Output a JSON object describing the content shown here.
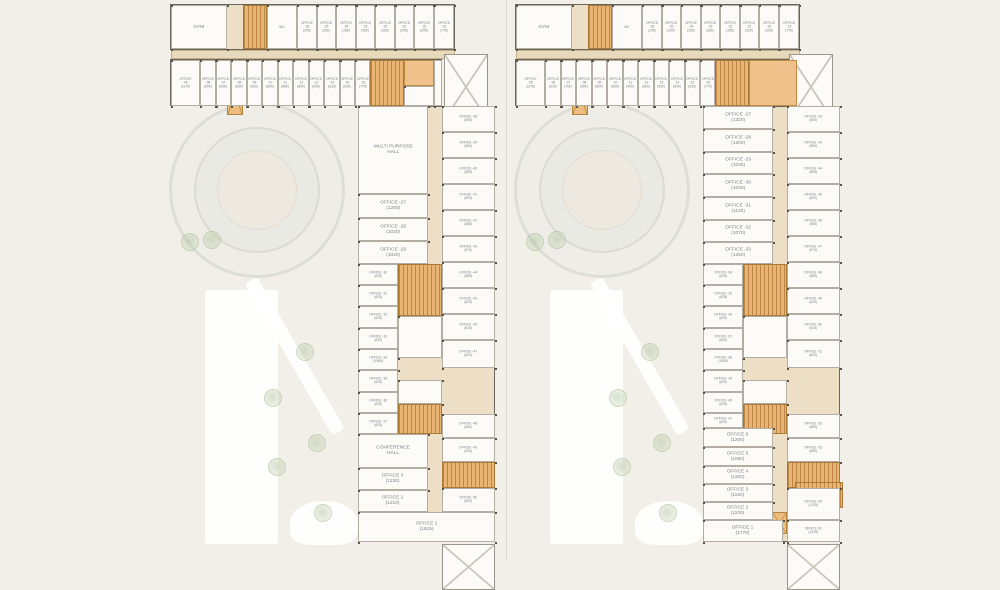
{
  "page": {
    "background": "#f2efe8",
    "divider_x": 506
  },
  "palette": {
    "corridor": "#ecdfc5",
    "room_white": "#fcfbf8",
    "core_orange": "#eec28a",
    "stair_orange": "#e8b574",
    "outline": "#6a665e",
    "label_text": "#7e7e85",
    "tree_green": "#a7bd92"
  },
  "plans": [
    {
      "name": "floor-plan-left",
      "x": 170,
      "y": 4,
      "w": 330,
      "h": 540,
      "site": {
        "circle": {
          "cx": 87,
          "cy": 186,
          "r": 88
        },
        "path_rect": {
          "x": 35,
          "y": 286,
          "w": 73,
          "h": 254
        },
        "path_diag": {
          "x": 75,
          "y": 280,
          "w": 14,
          "h": 175,
          "rot": -30
        },
        "path_blob": {
          "x": 120,
          "y": 497,
          "w": 68,
          "h": 44
        },
        "trees": [
          [
            20,
            238
          ],
          [
            42,
            236
          ],
          [
            135,
            348
          ],
          [
            103,
            394
          ],
          [
            147,
            439
          ],
          [
            107,
            463
          ],
          [
            153,
            509
          ]
        ]
      },
      "zones": [
        [
          0,
          0,
          285,
          46,
          "zone"
        ],
        [
          1,
          46,
          284,
          9,
          "tan"
        ],
        [
          0,
          55,
          272,
          47,
          "zone"
        ],
        [
          274,
          50,
          44,
          66,
          "ramp"
        ],
        [
          188,
          102,
          137,
          436,
          "zone"
        ]
      ],
      "rooms": [
        [
          1,
          1,
          56,
          44,
          "w",
          "GYM"
        ],
        [
          57,
          1,
          16,
          44,
          "lift"
        ],
        [
          73,
          1,
          24,
          44,
          "s"
        ],
        [
          97,
          1,
          30,
          44,
          "w",
          "WC"
        ],
        [
          127,
          1,
          19.5,
          44,
          "w",
          "OFFICE -26\n(295)"
        ],
        [
          146.5,
          1,
          19.5,
          44,
          "w",
          "OFFICE -25\n(290)"
        ],
        [
          166,
          1,
          19.5,
          44,
          "w",
          "OFFICE -24\n(285)"
        ],
        [
          185.5,
          1,
          19.5,
          44,
          "w",
          "OFFICE -23\n(280)"
        ],
        [
          205,
          1,
          19.5,
          44,
          "w",
          "OFFICE -22\n(285)"
        ],
        [
          224.5,
          1,
          19.5,
          44,
          "w",
          "OFFICE -21\n(290)"
        ],
        [
          244,
          1,
          19.5,
          44,
          "w",
          "OFFICE -20\n(295)"
        ],
        [
          263.5,
          1,
          20.5,
          44,
          "w",
          "OFFICE -19\n(775)"
        ],
        [
          1,
          56,
          29,
          46,
          "w",
          "OFFICE -05\n(1170)"
        ],
        [
          30,
          56,
          15.5,
          46,
          "w",
          "OFFICE -06\n(690)"
        ],
        [
          45.5,
          56,
          15.5,
          46,
          "w",
          "OFFICE -07\n(630)"
        ],
        [
          61,
          56,
          15.5,
          46,
          "w",
          "OFFICE -08\n(630)"
        ],
        [
          76.5,
          56,
          15.5,
          46,
          "w",
          "OFFICE -09\n(690)"
        ],
        [
          92,
          56,
          15.5,
          46,
          "w",
          "OFFICE -10\n(890)"
        ],
        [
          107.5,
          56,
          15.5,
          46,
          "w",
          "OFFICE -11\n(880)"
        ],
        [
          123,
          56,
          15.5,
          46,
          "w",
          "OFFICE -12\n(890)"
        ],
        [
          138.5,
          56,
          15.5,
          46,
          "w",
          "OFFICE -13\n(690)"
        ],
        [
          154,
          56,
          15.5,
          46,
          "w",
          "OFFICE -14\n(630)"
        ],
        [
          169.5,
          56,
          15.5,
          46,
          "w",
          "OFFICE -15\n(630)"
        ],
        [
          185,
          56,
          15,
          46,
          "w",
          "OFFICE -16\n(775)"
        ],
        [
          200,
          56,
          34,
          46,
          "s"
        ],
        [
          234,
          56,
          30,
          26,
          "o"
        ],
        [
          234,
          82,
          30,
          20,
          "w"
        ],
        [
          264,
          56,
          8,
          46,
          "w"
        ],
        [
          188,
          102,
          70,
          88,
          "w",
          "MULTI PURPOSE\nHALL"
        ],
        [
          188,
          190,
          70,
          24,
          "w",
          "OFFICE -27\n(1200)"
        ],
        [
          188,
          214,
          70,
          23,
          "w",
          "OFFICE -28\n(1030)"
        ],
        [
          188,
          237,
          70,
          23,
          "w",
          "OFFICE -29\n(1020)"
        ],
        [
          188,
          260,
          40,
          21,
          "w",
          "OFFICE -30\n(625)"
        ],
        [
          188,
          281,
          40,
          21,
          "w",
          "OFFICE -31\n(625)"
        ],
        [
          188,
          302,
          40,
          22,
          "w",
          "OFFICE -32\n(625)"
        ],
        [
          188,
          324,
          40,
          21,
          "w",
          "OFFICE -33\n(630)"
        ],
        [
          188,
          345,
          40,
          21,
          "w",
          "OFFICE -34\n(1060)"
        ],
        [
          188,
          366,
          40,
          22,
          "w",
          "OFFICE -35\n(625)"
        ],
        [
          188,
          388,
          40,
          21,
          "w",
          "OFFICE -36\n(625)"
        ],
        [
          188,
          409,
          40,
          21,
          "w",
          "OFFICE -37\n(625)"
        ],
        [
          228,
          260,
          44,
          52,
          "s"
        ],
        [
          228,
          312,
          44,
          42,
          "w"
        ],
        [
          228,
          354,
          14,
          22,
          "lift"
        ],
        [
          242,
          354,
          15,
          22,
          "lift"
        ],
        [
          257,
          354,
          15,
          22,
          "lift"
        ],
        [
          228,
          376,
          44,
          24,
          "w"
        ],
        [
          228,
          400,
          44,
          30,
          "s"
        ],
        [
          272,
          102,
          53,
          26,
          "w",
          "OFFICE -38\n(605)"
        ],
        [
          272,
          128,
          53,
          26,
          "w",
          "OFFICE -39\n(580)"
        ],
        [
          272,
          154,
          53,
          26,
          "w",
          "OFFICE -40\n(595)"
        ],
        [
          272,
          180,
          53,
          26,
          "w",
          "OFFICE -41\n(600)"
        ],
        [
          272,
          206,
          53,
          26,
          "w",
          "OFFICE -42\n(585)"
        ],
        [
          272,
          232,
          53,
          26,
          "w",
          "OFFICE -43\n(570)"
        ],
        [
          272,
          258,
          53,
          26,
          "w",
          "OFFICE -44\n(565)"
        ],
        [
          272,
          284,
          53,
          26,
          "w",
          "OFFICE -45\n(625)"
        ],
        [
          272,
          310,
          53,
          26,
          "w",
          "OFFICE -46\n(615)"
        ],
        [
          272,
          336,
          53,
          28,
          "w",
          "OFFICE -47\n(620)"
        ],
        [
          272,
          364,
          53,
          46,
          "ramp"
        ],
        [
          272,
          410,
          53,
          24,
          "w",
          "OFFICE -48\n(650)"
        ],
        [
          272,
          434,
          53,
          24,
          "w",
          "OFFICE -49\n(630)"
        ],
        [
          272,
          458,
          53,
          26,
          "s"
        ],
        [
          272,
          484,
          53,
          24,
          "w",
          "OFFICE -50\n(600)"
        ],
        [
          188,
          430,
          70,
          34,
          "w",
          "CONFERENCE\nHALL"
        ],
        [
          188,
          464,
          70,
          22,
          "w",
          "OFFICE 3\n(1230)"
        ],
        [
          188,
          486,
          70,
          22,
          "w",
          "OFFICE 2\n(1210)"
        ],
        [
          188,
          508,
          137,
          30,
          "w",
          "OFFICE 1\n(1615)"
        ]
      ]
    },
    {
      "name": "floor-plan-right",
      "x": 515,
      "y": 4,
      "w": 330,
      "h": 540,
      "site": {
        "circle": {
          "cx": 87,
          "cy": 186,
          "r": 88
        },
        "path_rect": {
          "x": 35,
          "y": 286,
          "w": 73,
          "h": 254
        },
        "path_diag": {
          "x": 75,
          "y": 280,
          "w": 14,
          "h": 175,
          "rot": -30
        },
        "path_blob": {
          "x": 120,
          "y": 497,
          "w": 68,
          "h": 44
        },
        "trees": [
          [
            20,
            238
          ],
          [
            42,
            236
          ],
          [
            135,
            348
          ],
          [
            103,
            394
          ],
          [
            147,
            439
          ],
          [
            107,
            463
          ],
          [
            153,
            509
          ]
        ]
      },
      "zones": [
        [
          0,
          0,
          285,
          46,
          "zone"
        ],
        [
          1,
          46,
          284,
          9,
          "tan"
        ],
        [
          0,
          55,
          282,
          47,
          "zone"
        ],
        [
          274,
          50,
          44,
          66,
          "ramp"
        ],
        [
          188,
          102,
          137,
          436,
          "zone"
        ]
      ],
      "rooms": [
        [
          1,
          1,
          56,
          44,
          "w",
          "GYM"
        ],
        [
          57,
          1,
          16,
          44,
          "lift"
        ],
        [
          73,
          1,
          24,
          44,
          "s"
        ],
        [
          97,
          1,
          30,
          44,
          "w",
          "WC"
        ],
        [
          127,
          1,
          19.5,
          44,
          "w",
          "OFFICE -26\n(295)"
        ],
        [
          146.5,
          1,
          19.5,
          44,
          "w",
          "OFFICE -25\n(290)"
        ],
        [
          166,
          1,
          19.5,
          44,
          "w",
          "OFFICE -24\n(285)"
        ],
        [
          185.5,
          1,
          19.5,
          44,
          "w",
          "OFFICE -23\n(280)"
        ],
        [
          205,
          1,
          19.5,
          44,
          "w",
          "OFFICE -22\n(285)"
        ],
        [
          224.5,
          1,
          19.5,
          44,
          "w",
          "OFFICE -21\n(290)"
        ],
        [
          244,
          1,
          19.5,
          44,
          "w",
          "OFFICE -20\n(295)"
        ],
        [
          263.5,
          1,
          20.5,
          44,
          "w",
          "OFFICE -19\n(775)"
        ],
        [
          1,
          56,
          29,
          46,
          "w",
          "OFFICE -05\n(1175)"
        ],
        [
          30,
          56,
          15.5,
          46,
          "w",
          "OFFICE -06\n(630)"
        ],
        [
          45.5,
          56,
          15.5,
          46,
          "w",
          "OFFICE -07\n(700)"
        ],
        [
          61,
          56,
          15.5,
          46,
          "w",
          "OFFICE -08\n(980)"
        ],
        [
          76.5,
          56,
          15.5,
          46,
          "w",
          "OFFICE -09\n(800)"
        ],
        [
          92,
          56,
          15.5,
          46,
          "w",
          "OFFICE -10\n(600)"
        ],
        [
          107.5,
          56,
          15.5,
          46,
          "w",
          "OFFICE -11\n(400)"
        ],
        [
          123,
          56,
          15.5,
          46,
          "w",
          "OFFICE -12\n(860)"
        ],
        [
          138.5,
          56,
          15.5,
          46,
          "w",
          "OFFICE -13\n(500)"
        ],
        [
          154,
          56,
          15.5,
          46,
          "w",
          "OFFICE -14\n(840)"
        ],
        [
          169.5,
          56,
          15.5,
          46,
          "w",
          "OFFICE -15\n(630)"
        ],
        [
          185,
          56,
          15,
          46,
          "w",
          "OFFICE -16\n(770)"
        ],
        [
          200,
          56,
          34,
          46,
          "s"
        ],
        [
          234,
          56,
          48,
          46,
          "o"
        ],
        [
          188,
          102,
          70,
          23,
          "w",
          "OFFICE -27\n(1320)"
        ],
        [
          188,
          125,
          70,
          23,
          "w",
          "OFFICE -28\n(1200)"
        ],
        [
          188,
          148,
          70,
          22,
          "w",
          "OFFICE -29\n(1030)"
        ],
        [
          188,
          170,
          70,
          23,
          "w",
          "OFFICE -30\n(1030)"
        ],
        [
          188,
          193,
          70,
          23,
          "w",
          "OFFICE -31\n(1120)"
        ],
        [
          188,
          216,
          70,
          22,
          "w",
          "OFFICE -32\n(1070)"
        ],
        [
          188,
          238,
          70,
          22,
          "w",
          "OFFICE -33\n(1260)"
        ],
        [
          188,
          260,
          40,
          21,
          "w",
          "OFFICE -34\n(625)"
        ],
        [
          188,
          281,
          40,
          21,
          "w",
          "OFFICE -35\n(625)"
        ],
        [
          188,
          302,
          40,
          22,
          "w",
          "OFFICE -36\n(625)"
        ],
        [
          188,
          324,
          40,
          21,
          "w",
          "OFFICE -37\n(630)"
        ],
        [
          188,
          345,
          40,
          21,
          "w",
          "OFFICE -38\n(1060)"
        ],
        [
          188,
          366,
          40,
          22,
          "w",
          "OFFICE -39\n(625)"
        ],
        [
          188,
          388,
          40,
          21,
          "w",
          "OFFICE -40\n(625)"
        ],
        [
          188,
          409,
          40,
          15,
          "w",
          "OFFICE -41\n(625)"
        ],
        [
          228,
          260,
          44,
          52,
          "s"
        ],
        [
          228,
          312,
          44,
          42,
          "w"
        ],
        [
          228,
          354,
          14,
          22,
          "lift"
        ],
        [
          242,
          354,
          15,
          22,
          "lift"
        ],
        [
          257,
          354,
          15,
          22,
          "lift"
        ],
        [
          228,
          376,
          44,
          24,
          "w"
        ],
        [
          228,
          400,
          44,
          30,
          "s"
        ],
        [
          272,
          102,
          53,
          26,
          "w",
          "OFFICE -42\n(605)"
        ],
        [
          272,
          128,
          53,
          26,
          "w",
          "OFFICE -43\n(580)"
        ],
        [
          272,
          154,
          53,
          26,
          "w",
          "OFFICE -44\n(595)"
        ],
        [
          272,
          180,
          53,
          26,
          "w",
          "OFFICE -45\n(600)"
        ],
        [
          272,
          206,
          53,
          26,
          "w",
          "OFFICE -46\n(585)"
        ],
        [
          272,
          232,
          53,
          26,
          "w",
          "OFFICE -47\n(570)"
        ],
        [
          272,
          258,
          53,
          26,
          "w",
          "OFFICE -48\n(565)"
        ],
        [
          272,
          284,
          53,
          26,
          "w",
          "OFFICE -49\n(625)"
        ],
        [
          272,
          310,
          53,
          26,
          "w",
          "OFFICE -50\n(615)"
        ],
        [
          272,
          336,
          53,
          28,
          "w",
          "OFFICE -51\n(620)"
        ],
        [
          272,
          364,
          53,
          46,
          "ramp"
        ],
        [
          272,
          410,
          53,
          24,
          "w",
          "OFFICE -52\n(860)"
        ],
        [
          272,
          434,
          53,
          24,
          "w",
          "OFFICE -53\n(890)"
        ],
        [
          272,
          458,
          53,
          26,
          "s"
        ],
        [
          280,
          478,
          48,
          26,
          "s"
        ],
        [
          272,
          484,
          53,
          32,
          "w",
          "OFFICE -54\n(1015)"
        ],
        [
          188,
          424,
          70,
          19,
          "w",
          "OFFICE 6\n(1200)"
        ],
        [
          188,
          443,
          70,
          19,
          "w",
          "OFFICE 5\n(1090)"
        ],
        [
          188,
          462,
          70,
          18,
          "w",
          "OFFICE 4\n(1200)"
        ],
        [
          188,
          480,
          70,
          18,
          "w",
          "OFFICE 3\n(1150)"
        ],
        [
          188,
          498,
          70,
          18,
          "w",
          "OFFICE 2\n(1100)"
        ],
        [
          188,
          516,
          80,
          22,
          "w",
          "OFFICE 1\n(1770)"
        ],
        [
          272,
          516,
          53,
          22,
          "w",
          "OFFICE 02\n(1315)"
        ]
      ]
    }
  ]
}
